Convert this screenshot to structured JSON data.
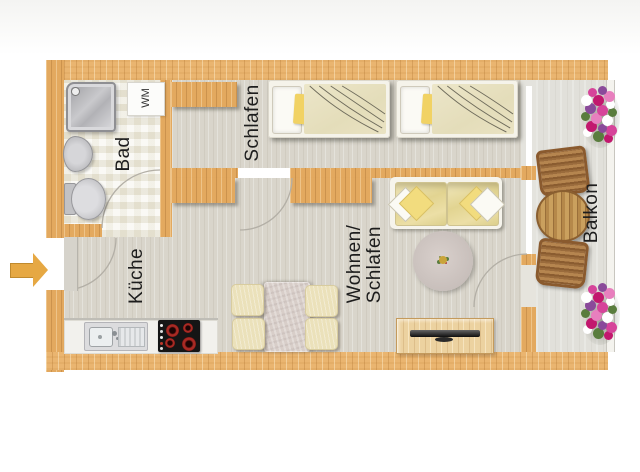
{
  "meta": {
    "type": "floor-plan"
  },
  "rooms": {
    "bad": {
      "label": "Bad"
    },
    "schlafen": {
      "label": "Schlafen"
    },
    "kueche": {
      "label": "Küche"
    },
    "wohnen_schlafen": {
      "label_line1": "Wohnen/",
      "label_line2": "Schlafen"
    },
    "balkon": {
      "label": "Balkon"
    }
  },
  "appliances": {
    "waschmaschine": {
      "label": "WM"
    }
  },
  "icons": {
    "entry_arrow": "entry-direction-arrow"
  },
  "colors": {
    "wall_wood": "#eab570",
    "floor_interior": "#d9d5cb",
    "floor_bathroom": "#f4f2ea",
    "floor_balcony": "#e1e0da",
    "entry_arrow": "#e6a843",
    "stove_top": "#151515",
    "burner_red": "#a82a24",
    "cushion_yellow": "#f2dc7e",
    "pillow_yellow": "#f1d264",
    "flower_pink": "#d6449a",
    "flower_purple": "#8a4a9a",
    "flower_white": "#ffffff",
    "leaf_green": "#5a7d3e"
  }
}
